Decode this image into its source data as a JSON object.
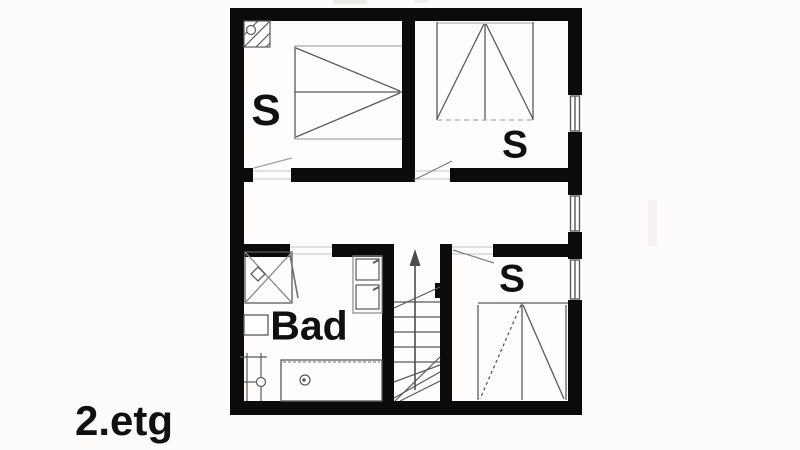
{
  "floor_label": "2.etg",
  "rooms": [
    {
      "name": "bedroom-top-left",
      "label": "S"
    },
    {
      "name": "bedroom-top-right",
      "label": "S"
    },
    {
      "name": "bedroom-bottom-right",
      "label": "S"
    },
    {
      "name": "bathroom",
      "label": "Bad"
    },
    {
      "name": "hallway",
      "label": ""
    },
    {
      "name": "staircase",
      "label": ""
    }
  ],
  "icons": {
    "bed": "triangle-fan bed symbol",
    "chimney": "hatched square with circle",
    "shower": "square with X cross and drain",
    "bathtub": "rectangle with drain circle",
    "washbasin": "small wall rectangle",
    "towel-radiator": "ladder with valve circle",
    "cabinet": "double stacked squares",
    "stairs": "treads with up arrow",
    "window": "double-line wall inset"
  },
  "colors": {
    "wall": "#0b0b0b",
    "line_strong": "#5a5a5a",
    "line_light": "#9f9f9f",
    "threshold": "#c6c3c0",
    "text": "#101010",
    "floor": "#fefdfc",
    "background": "#fdfcfb"
  }
}
